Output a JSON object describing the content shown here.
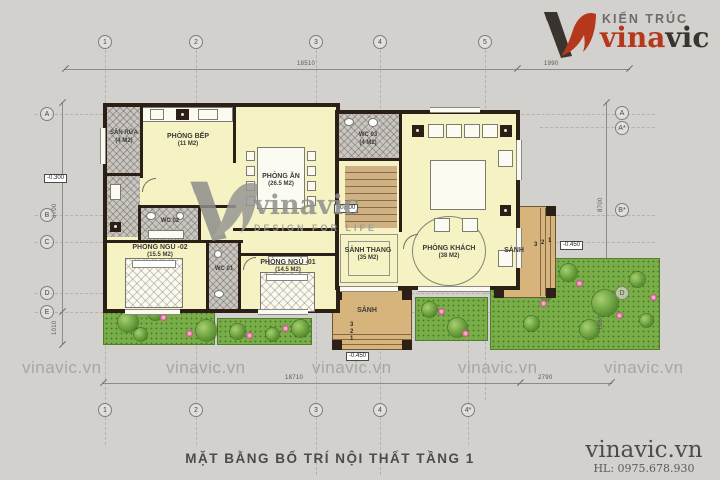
{
  "drawing_title": "MẶT BẰNG BỐ TRÍ NỘI THẤT TẦNG 1",
  "logo": {
    "tagline": "KIẾN TRÚC",
    "brand_red": "vina",
    "brand_dark": "vic"
  },
  "footer": {
    "site": "vinavic.vn",
    "hotline": "HL: 0975.678.930"
  },
  "watermark": {
    "brand": "vinavic",
    "slogan": "DESIGN FOR LIFE",
    "tiles": [
      "vinavic.vn",
      "vinavic.vn",
      "vinavic.vn",
      "vinavic.vn",
      "vinavic.vn"
    ]
  },
  "grid": {
    "top": [
      "1",
      "2",
      "3",
      "4",
      "5"
    ],
    "bottom": [
      "1",
      "2",
      "3",
      "4",
      "4*"
    ],
    "left": [
      "A",
      "B",
      "C",
      "D",
      "E"
    ],
    "right": [
      "A",
      "A*",
      "B*",
      "D"
    ]
  },
  "dims": {
    "top_main": "18510",
    "top_right": "1990",
    "bottom_main": "18710",
    "bottom_right": "2790",
    "left_main": "8700",
    "left_lower": "1010",
    "right_main": "8700",
    "right_lower": "1660"
  },
  "levels": {
    "entry": "-0.300",
    "ground": "±0.000",
    "porch_front": "-0.450",
    "porch_side": "-0.450"
  },
  "rooms": {
    "san_rua": {
      "name": "SÂN RỬA",
      "area": "(4 M2)"
    },
    "bep": {
      "name": "PHÒNG BẾP",
      "area": "(11 M2)"
    },
    "an": {
      "name": "PHÒNG ĂN",
      "area": "(26.5 M2)"
    },
    "wc03": {
      "name": "WC 03",
      "area": "(4 M2)"
    },
    "wc02": {
      "name": "WC 02",
      "area": "(5 M2)"
    },
    "wc01": {
      "name": "WC 01",
      "area": "(5 M2)"
    },
    "ngu02": {
      "name": "PHÒNG NGỦ -02",
      "area": "(15.5 M2)"
    },
    "ngu01": {
      "name": "PHÒNG NGỦ -01",
      "area": "(14.5 M2)"
    },
    "sanh_thang": {
      "name": "SẢNH THANG",
      "area": "(35 M2)"
    },
    "khach": {
      "name": "PHÒNG KHÁCH",
      "area": "(38 M2)"
    },
    "sanh_front": {
      "name": "SẢNH"
    },
    "sanh_side": {
      "name": "SẢNH"
    }
  },
  "steps": {
    "front": [
      "3",
      "2",
      "1"
    ],
    "side": [
      "3",
      "2",
      "1"
    ]
  },
  "colors": {
    "accent_red": "#b5381d",
    "wall": "#2b1f16",
    "room_fill": "#f5f2c3",
    "garden": "#79ad47",
    "porch": "#d6b47c",
    "paper": "#d3d1ce"
  }
}
